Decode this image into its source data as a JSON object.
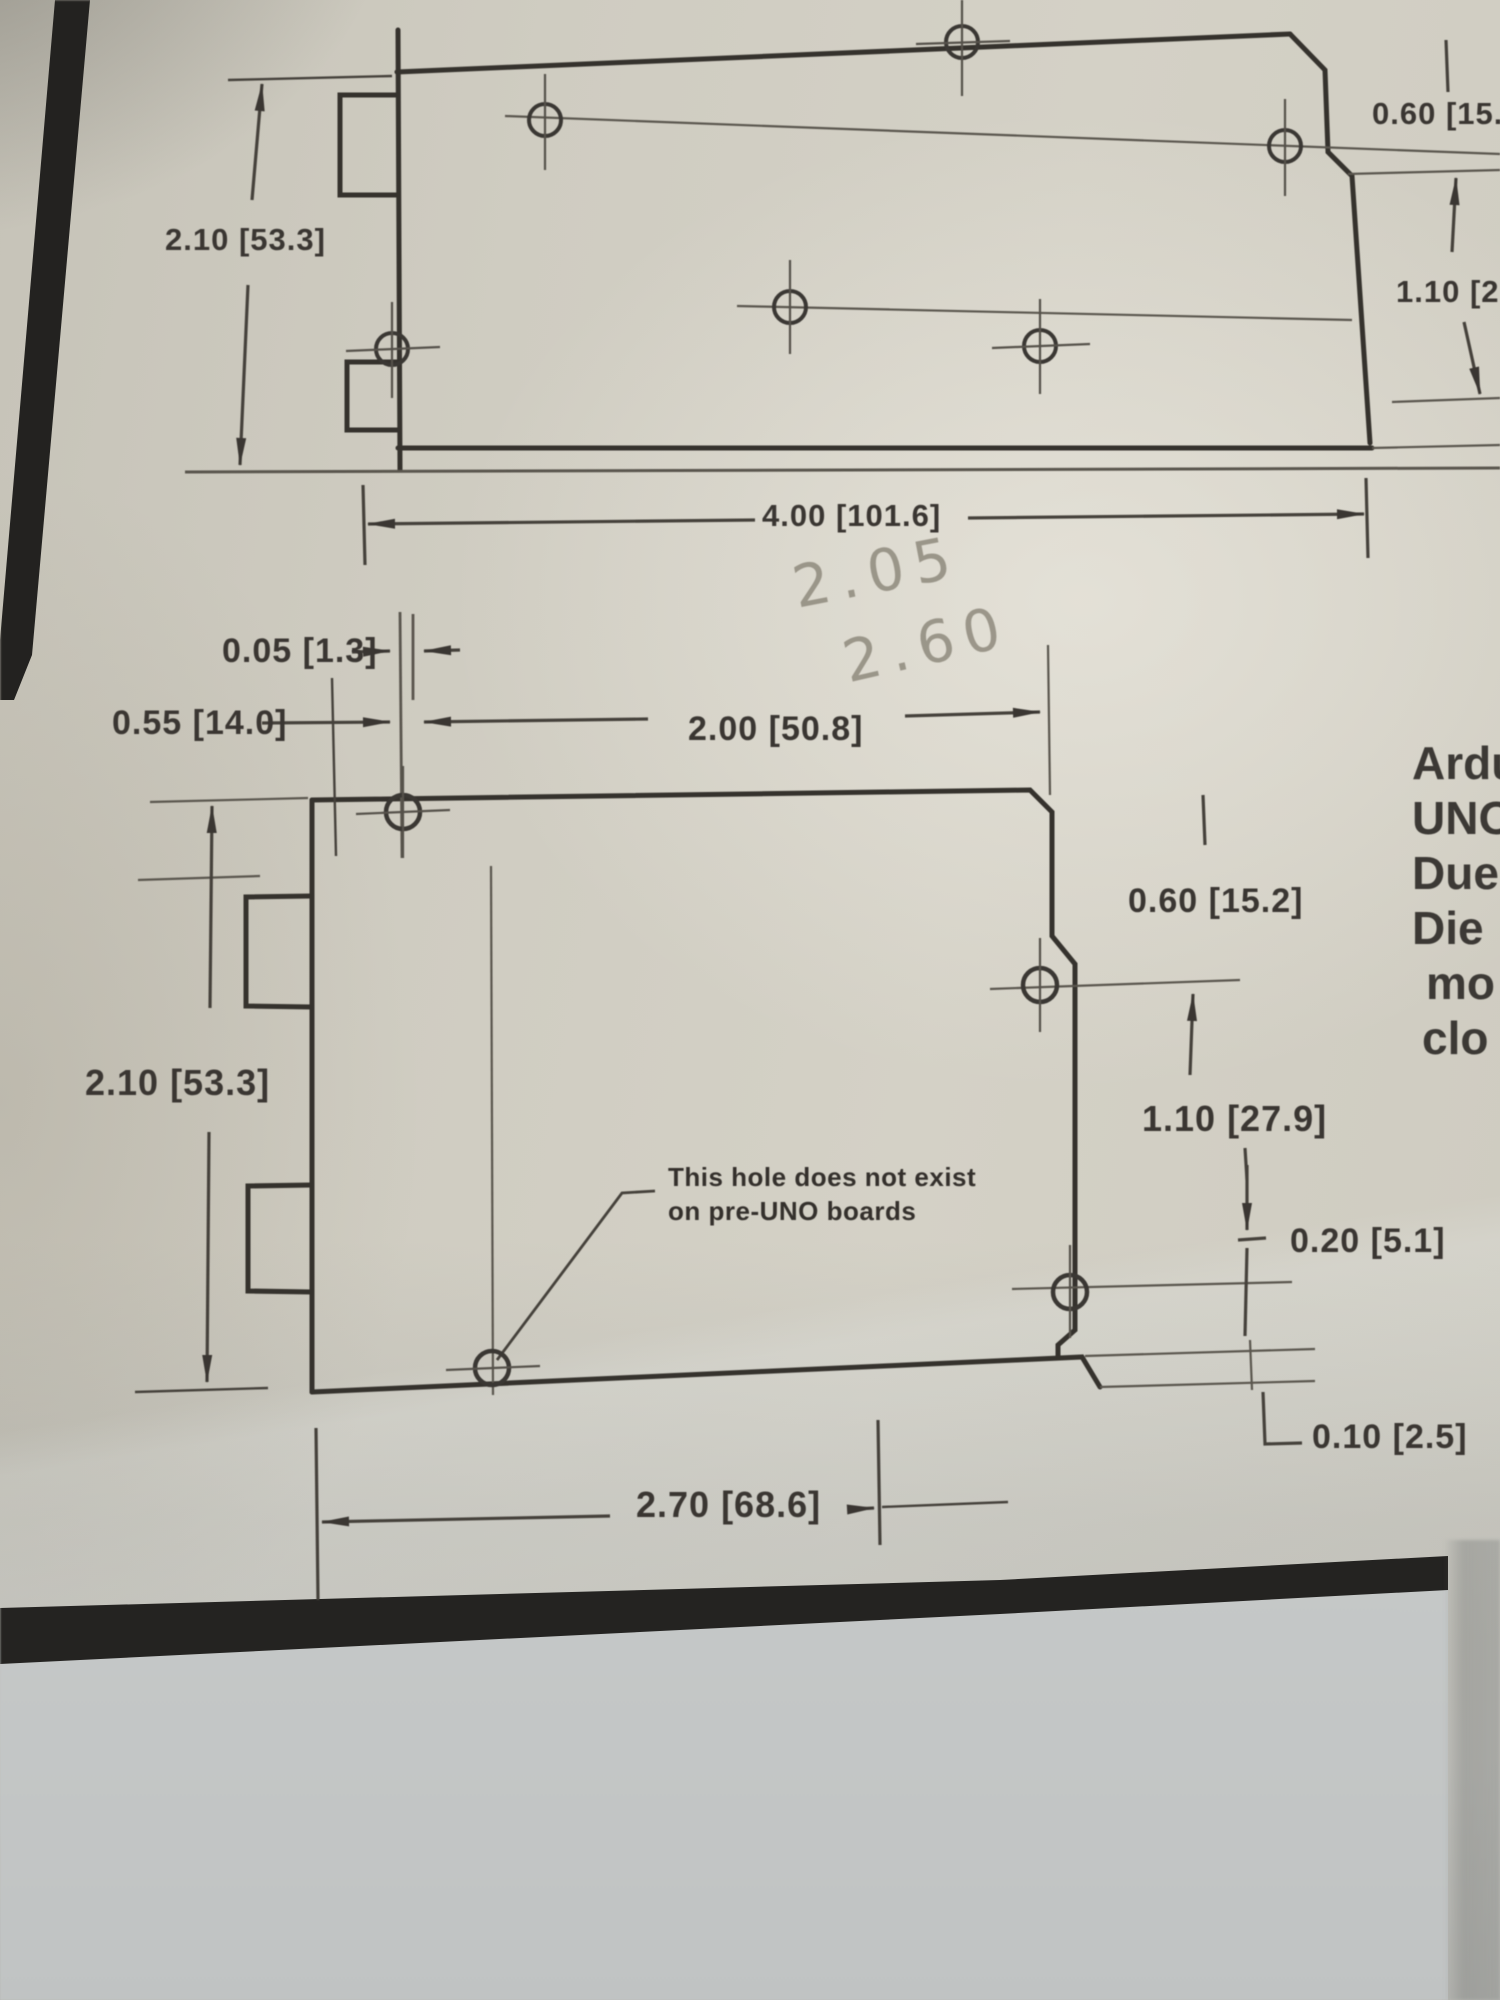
{
  "colors": {
    "paper": "#cfccc1",
    "ink": "#3a3632",
    "pencil": "#8f8a7d",
    "black_bar": "#232220"
  },
  "upper_drawing": {
    "dim_left_height": "2.10 [53.3]",
    "dim_bottom_width": "4.00 [101.6]",
    "dim_right_top": "0.60 [15.2",
    "dim_right_mid": "1.10 [2"
  },
  "handwritten": {
    "value1": "2.05",
    "value2": "2.60"
  },
  "lower_drawing": {
    "dim_hole_offset": "0.05 [1.3]",
    "dim_left_inset": "0.55 [14.0]",
    "dim_top_width": "2.00 [50.8]",
    "dim_right_top": "0.60 [15.2]",
    "dim_left_height": "2.10 [53.3]",
    "dim_right_mid": "1.10 [27.9]",
    "dim_right_lower": "0.20 [5.1]",
    "dim_right_bottom": "0.10 [2.5]",
    "dim_bottom_width": "2.70 [68.6]",
    "note": {
      "line1": "This hole does not exist",
      "line2": "on pre-UNO boards"
    }
  },
  "margin_text": {
    "lines": [
      "Ardu",
      "UNO",
      "Due",
      "Die",
      "mo",
      "clo"
    ]
  }
}
